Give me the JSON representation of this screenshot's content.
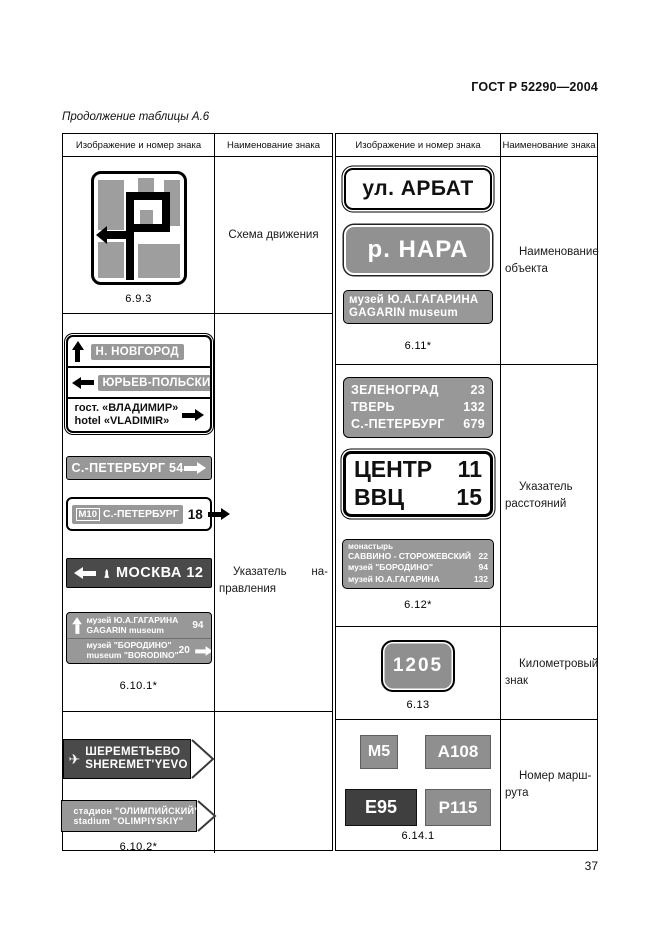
{
  "page": {
    "standard": "ГОСТ Р 52290—2004",
    "table_caption": "Продолжение таблицы А.6",
    "page_number": "37"
  },
  "table_headers": [
    "Изображение и номер знака",
    "Наименование знака",
    "Изображение и номер знака",
    "Наименование знака"
  ],
  "colors": {
    "sign_gray": "#989898",
    "sign_dark": "#4a4a4a",
    "paper": "#ffffff",
    "ink": "#111111"
  },
  "left": {
    "row1": {
      "number": "6.9.3",
      "name": "Схема движения"
    },
    "row2": {
      "number": "6.10.1*",
      "name_l1a": "Указатель",
      "name_l1b": "на-",
      "name_l2": "правления",
      "signA": {
        "r1": "Н. НОВГОРОД",
        "r2": "ЮРЬЕВ-ПОЛЬСКИЙ",
        "r3a": "гост. «ВЛАДИМИР»",
        "r3b": "hotel «VLADIMIR»"
      },
      "signB": {
        "text": "С.-ПЕТЕРБУРГ 54"
      },
      "signC": {
        "badge": "М10",
        "city": "С.-ПЕТЕРБУРГ",
        "dist": "18"
      },
      "signD": {
        "text": "МОСКВА 12"
      },
      "signE": {
        "r1a": "музей Ю.А.ГАГАРИНА",
        "r1b": "GAGARIN museum",
        "r1n": "94",
        "r2a": "музей \"БОРОДИНО\"",
        "r2b": "museum \"BORODINO\"",
        "r2n": "20"
      }
    },
    "row3": {
      "number": "6.10.2*",
      "signF": {
        "l1": "ШЕРЕМЕТЬЕВО",
        "l2": "SHEREMET'YEVO",
        "n": "3"
      },
      "signG": {
        "l1": "стадион \"ОЛИМПИЙСКИЙ\"",
        "l2": "stadium \"OLIMPIYSKIY\"",
        "n": "3"
      }
    }
  },
  "right": {
    "row1": {
      "number": "6.11*",
      "name_l1": "Наименование",
      "name_l2": "объекта",
      "street": "ул. АРБАТ",
      "river": "р. НАРА",
      "museum_l1": "музей Ю.А.ГАГАРИНА",
      "museum_l2": "GAGARIN museum"
    },
    "row2": {
      "number": "6.12*",
      "name_l1": "Указатель",
      "name_l2": "расстояний",
      "dist1": [
        [
          "ЗЕЛЕНОГРАД",
          "23"
        ],
        [
          "ТВЕРЬ",
          "132"
        ],
        [
          "С.-ПЕТЕРБУРГ",
          "679"
        ]
      ],
      "dist2": [
        [
          "ЦЕНТР",
          "11"
        ],
        [
          "ВВЦ",
          "15"
        ]
      ],
      "dist3_title": "монастырь",
      "dist3": [
        [
          "САВВИНО - СТОРОЖЕВСКИЙ",
          "22"
        ],
        [
          "музей \"БОРОДИНО\"",
          "94"
        ],
        [
          "музей Ю.А.ГАГАРИНА",
          "132"
        ]
      ]
    },
    "row3": {
      "number": "6.13",
      "name_l1": "Километровый",
      "name_l2": "знак",
      "km": "1205"
    },
    "row4": {
      "number": "6.14.1",
      "name_l1": "Номер марш-",
      "name_l2": "рута",
      "routes": [
        "М5",
        "А108",
        "Е95",
        "Р115"
      ]
    }
  }
}
